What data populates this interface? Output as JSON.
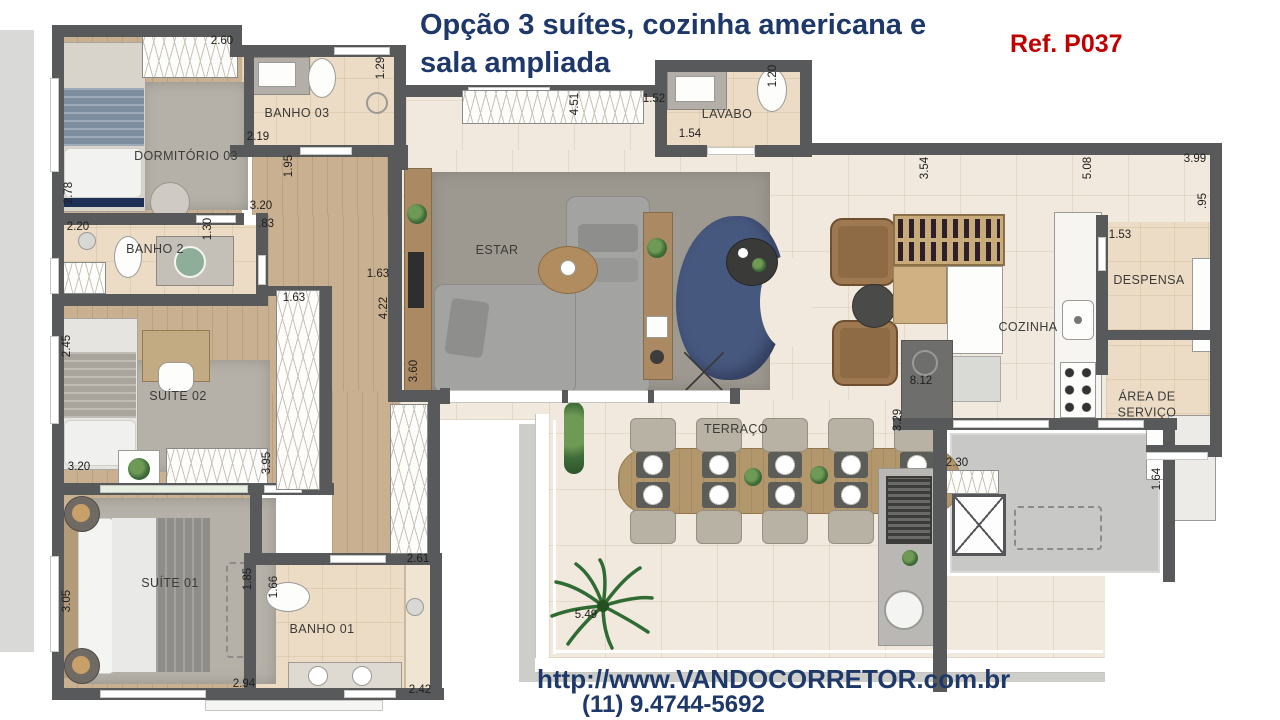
{
  "header": {
    "title": "Opção 3 suítes, cozinha americana e\nsala ampliada",
    "ref": "Ref. P037"
  },
  "footer": {
    "url": "http://www.VANDOCORRETOR.com.br",
    "phone": "(11) 9.4744-5692"
  },
  "colors": {
    "title_navy": "#1d3869",
    "ref_red": "#c00000",
    "wall_gray": "#58595a",
    "floor_cream": "#f1e9dd",
    "wood": "#c9b091",
    "sofa_blue": "#47587f"
  },
  "plan": {
    "rooms": [
      {
        "label": "DORMITÓRIO 03",
        "x": 186,
        "y": 157
      },
      {
        "label": "BANHO 03",
        "x": 297,
        "y": 114
      },
      {
        "label": "BANHO 2",
        "x": 155,
        "y": 250
      },
      {
        "label": "SUÍTE 02",
        "x": 178,
        "y": 397
      },
      {
        "label": "SUÍTE 01",
        "x": 170,
        "y": 584
      },
      {
        "label": "BANHO 01",
        "x": 322,
        "y": 630
      },
      {
        "label": "ESTAR",
        "x": 497,
        "y": 251
      },
      {
        "label": "LAVABO",
        "x": 727,
        "y": 115
      },
      {
        "label": "COZINHA",
        "x": 1028,
        "y": 328
      },
      {
        "label": "DESPENSA",
        "x": 1149,
        "y": 281
      },
      {
        "label": "ÁREA DE\nSERVIÇO",
        "x": 1147,
        "y": 405
      },
      {
        "label": "TERRAÇO",
        "x": 736,
        "y": 430
      }
    ],
    "dims": [
      {
        "v": "2.60",
        "x": 222,
        "y": 41
      },
      {
        "v": "1.29",
        "x": 381,
        "y": 68,
        "r": 1
      },
      {
        "v": "2.19",
        "x": 258,
        "y": 137
      },
      {
        "v": "1.95",
        "x": 289,
        "y": 166,
        "r": 1
      },
      {
        "v": "3.20",
        "x": 261,
        "y": 206
      },
      {
        "v": ".83",
        "x": 266,
        "y": 224
      },
      {
        "v": "2.78",
        "x": 69,
        "y": 193,
        "r": 1
      },
      {
        "v": "2.20",
        "x": 78,
        "y": 227
      },
      {
        "v": "1.30",
        "x": 208,
        "y": 229,
        "r": 1
      },
      {
        "v": "1.63",
        "x": 294,
        "y": 298
      },
      {
        "v": "1.63",
        "x": 378,
        "y": 274
      },
      {
        "v": "4.22",
        "x": 384,
        "y": 308,
        "r": 1
      },
      {
        "v": "3.60",
        "x": 414,
        "y": 371,
        "r": 1
      },
      {
        "v": "2.45",
        "x": 67,
        "y": 346,
        "r": 1
      },
      {
        "v": "3.20",
        "x": 79,
        "y": 467
      },
      {
        "v": "3.95",
        "x": 267,
        "y": 463,
        "r": 1
      },
      {
        "v": "3.05",
        "x": 67,
        "y": 601,
        "r": 1
      },
      {
        "v": "1.85",
        "x": 248,
        "y": 579,
        "r": 1
      },
      {
        "v": "1.66",
        "x": 274,
        "y": 587,
        "r": 1
      },
      {
        "v": "2.61",
        "x": 418,
        "y": 559
      },
      {
        "v": "2.94",
        "x": 244,
        "y": 684
      },
      {
        "v": "2.42",
        "x": 420,
        "y": 690
      },
      {
        "v": "4.51",
        "x": 575,
        "y": 104,
        "r": 1
      },
      {
        "v": "1.52",
        "x": 654,
        "y": 99
      },
      {
        "v": "1.54",
        "x": 690,
        "y": 134
      },
      {
        "v": "1.20",
        "x": 773,
        "y": 76,
        "r": 1
      },
      {
        "v": "3.54",
        "x": 925,
        "y": 168,
        "r": 1
      },
      {
        "v": "5.08",
        "x": 1088,
        "y": 168,
        "r": 1
      },
      {
        "v": "3.99",
        "x": 1195,
        "y": 159
      },
      {
        "v": ".95",
        "x": 1203,
        "y": 201,
        "r": 1
      },
      {
        "v": "1.53",
        "x": 1120,
        "y": 235
      },
      {
        "v": "8.12",
        "x": 921,
        "y": 381
      },
      {
        "v": "3.29",
        "x": 898,
        "y": 420,
        "r": 1
      },
      {
        "v": "2.30",
        "x": 957,
        "y": 463
      },
      {
        "v": "1.64",
        "x": 1157,
        "y": 479,
        "r": 1
      },
      {
        "v": "5.49",
        "x": 586,
        "y": 615
      }
    ]
  }
}
